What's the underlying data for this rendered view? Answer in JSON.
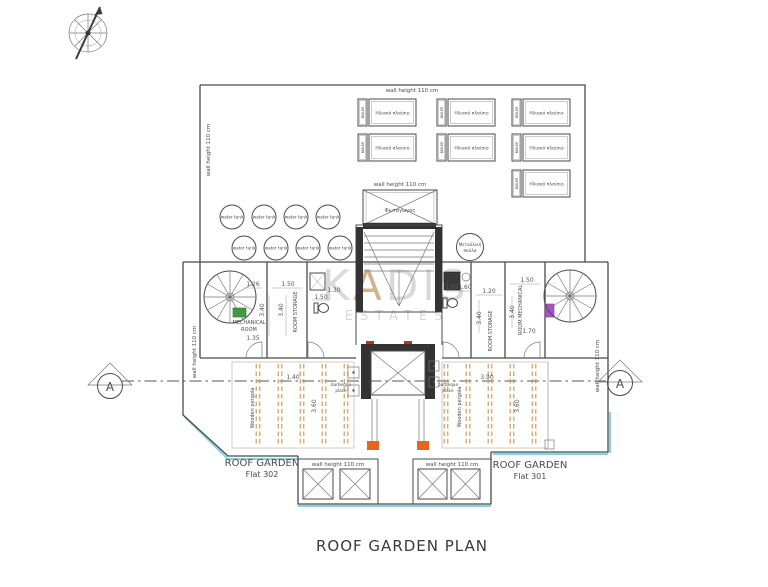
{
  "title": "ROOF GARDEN PLAN",
  "watermark": {
    "k": "K",
    "a": "A",
    "dis": "DIS",
    "estates": "ESTATES"
  },
  "labels": {
    "wall_height": "wall height 110 cm",
    "water_tank": "water tank",
    "solar_panel": "Ηλιακό πλαίσιο",
    "boiler": "BOILER",
    "light_well": "Φωταγωγός",
    "metal_stair_1": "Μεταλλική",
    "metal_stair_2": "σκάλα",
    "mech_room_1": "MECHANICAL",
    "mech_room_2": "ROOM",
    "room_storage": "ROOM STORAGE",
    "room_mechanical": "ROOM MECHANICAL",
    "wooden_pergola": "Wooden pergola",
    "barbeque_1": "barbeque",
    "barbeque_2": "place",
    "garden_302_1": "ROOF GARDEN",
    "garden_302_2": "Flat 302",
    "garden_301_1": "ROOF GARDEN",
    "garden_301_2": "Flat 301",
    "section": "A"
  },
  "dims": {
    "d126": "1.26",
    "d135": "1.35",
    "d150": "1.50",
    "d340": "3.40",
    "d130": "1.30",
    "d165": "1.65",
    "d160": "1.60",
    "d120": "1.20",
    "d170": "1.70",
    "d140": "1.40",
    "d390": "3.90",
    "d360": "3.60"
  },
  "colors": {
    "wall": "#4a4a4a",
    "pergola_orange": "#d09248",
    "marker_orange": "#e2661f",
    "door_green": "#3f9b3f",
    "door_purple": "#a855cc",
    "water_cyan": "#8ad0df",
    "watermark_tan": "#c8a87e",
    "tick_red": "#cc2a2a"
  }
}
